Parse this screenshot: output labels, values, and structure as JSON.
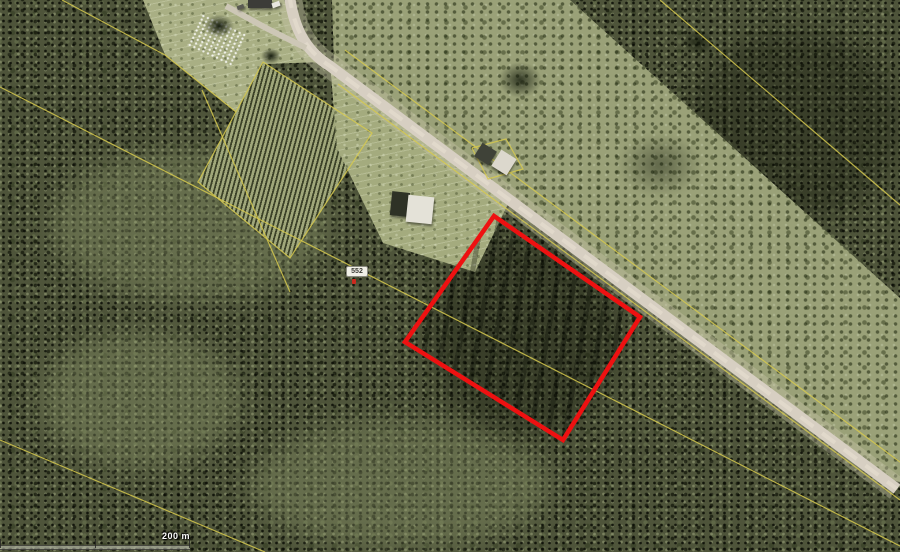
{
  "map": {
    "description": "Aerial orthophoto with rural road, fields, tree plantation and forest; a surveyed parcel outlined in red",
    "parcel_outline": {
      "color": "#ee1111",
      "stroke_width": 4.5,
      "points": "494,216 640,317 563,440 405,342"
    },
    "road": {
      "color": "#d7cfc2",
      "center_color": "#e1d9cb",
      "verge_color": "rgba(200,198,168,0.38)",
      "width": 11,
      "path": "M 289,-8 C 293,26 304,50 330,66 L 897,489"
    },
    "driveway": {
      "color": "#cdc7b6",
      "width": 6,
      "path": "M 306,48 L 266,28 L 226,6"
    },
    "cadastral": {
      "color": "#d6c94e",
      "lines": [
        {
          "name": "cadastral-line-field-edge",
          "points": "62,0 165,55 236,112"
        },
        {
          "name": "cadastral-line-long-diagonal",
          "points": "0,87 900,546"
        },
        {
          "name": "cadastral-line-bottom-left",
          "points": "0,440 265,552"
        },
        {
          "name": "cadastral-line-top-right",
          "points": "660,0 900,205"
        },
        {
          "name": "cadastral-line-road-upper",
          "points": "345,50 908,468"
        },
        {
          "name": "cadastral-line-road-lower",
          "points": "338,84 900,500"
        },
        {
          "name": "cadastral-line-plantation-boundary",
          "points": "263,62 372,133 290,258 198,182 263,62"
        },
        {
          "name": "cadastral-line-plantation-west",
          "points": "202,90 290,292"
        },
        {
          "name": "cadastral-line-house-yard",
          "points": "472,148 506,139 523,169 488,179 472,148"
        }
      ]
    },
    "buildings": [
      {
        "name": "farm-building",
        "x": 248,
        "y": 0,
        "w": 24,
        "h": 8,
        "rot": 0,
        "color": "#3c3c38"
      },
      {
        "name": "vehicle-light",
        "x": 272,
        "y": 2,
        "w": 8,
        "h": 5,
        "rot": -20,
        "color": "#e9e7df"
      },
      {
        "name": "vehicle-dark",
        "x": 237,
        "y": 5,
        "w": 7,
        "h": 4,
        "rot": -20,
        "color": "#5a5a52"
      },
      {
        "name": "barn-dark-section",
        "x": 391,
        "y": 192,
        "w": 18,
        "h": 24,
        "rot": 6,
        "color": "#2e3226"
      },
      {
        "name": "barn-white-roof",
        "x": 407,
        "y": 196,
        "w": 26,
        "h": 27,
        "rot": 6,
        "color": "#e4e2d8"
      },
      {
        "name": "house-dark-roof",
        "x": 477,
        "y": 146,
        "w": 17,
        "h": 16,
        "rot": 32,
        "color": "#3f4238"
      },
      {
        "name": "house-white-roof",
        "x": 495,
        "y": 153,
        "w": 18,
        "h": 19,
        "rot": 32,
        "color": "#dcd8cd"
      }
    ],
    "lot_badge": {
      "label": "552"
    },
    "scale_bar": {
      "label": "200 m"
    }
  }
}
